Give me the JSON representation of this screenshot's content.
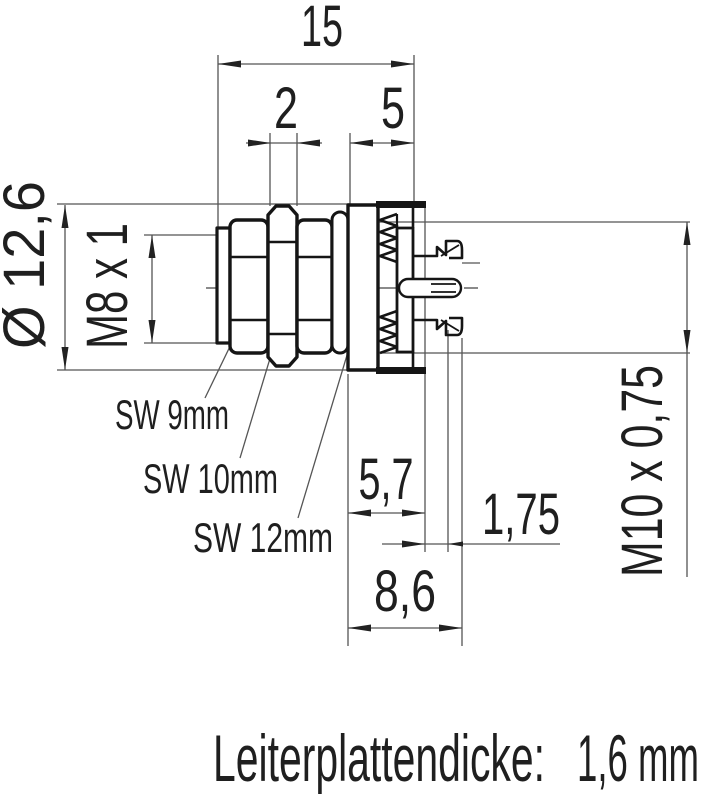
{
  "drawing": {
    "dims": {
      "total_width": "15",
      "nut_width": "2",
      "rear_length": "5",
      "flange_diameter": "Ø 12,6",
      "front_thread": "M8 x 1",
      "rear_thread": "M10 x 0,75",
      "panel_depth": "5,7",
      "clamp_gap": "1,75",
      "rear_depth": "8,6"
    },
    "wrench_labels": {
      "sw9": "SW 9mm",
      "sw10": "SW 10mm",
      "sw12": "SW 12mm"
    },
    "footer": {
      "label": "Leiterplattendicke:",
      "value": "1,6 mm"
    },
    "colors": {
      "line_thin": "#555555",
      "line_body": "#151515",
      "text": "#1f1f1f",
      "background": "#ffffff"
    }
  }
}
